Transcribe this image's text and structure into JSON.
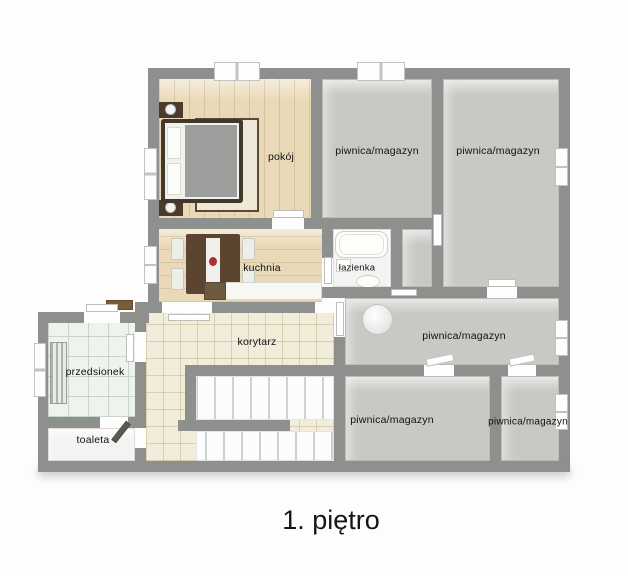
{
  "title": "1. piętro",
  "rooms": {
    "pokoj": {
      "label": "pokój"
    },
    "piwnica_top_left": {
      "label": "piwnica/magazyn"
    },
    "piwnica_top_right": {
      "label": "piwnica/magazyn"
    },
    "kuchnia": {
      "label": "kuchnia"
    },
    "lazienka": {
      "label": "łazienka"
    },
    "piwnica_middle": {
      "label": "piwnica/magazyn"
    },
    "korytarz": {
      "label": "korytarz"
    },
    "przedsionek": {
      "label": "przedsionek"
    },
    "toaleta": {
      "label": "toaleta"
    },
    "piwnica_bottom_left": {
      "label": "piwnica/magazyn"
    },
    "piwnica_bottom_right": {
      "label": "piwnica/magazyn"
    }
  },
  "colors": {
    "wall": "#8e908e",
    "floor_storage": "#c7c9c5",
    "floor_wood": "#e9d9b6",
    "floor_tile_cream": "#f2edda",
    "floor_tile_green": "#eef3ed",
    "floor_white": "#f3f4f2",
    "label_text": "#111111"
  }
}
